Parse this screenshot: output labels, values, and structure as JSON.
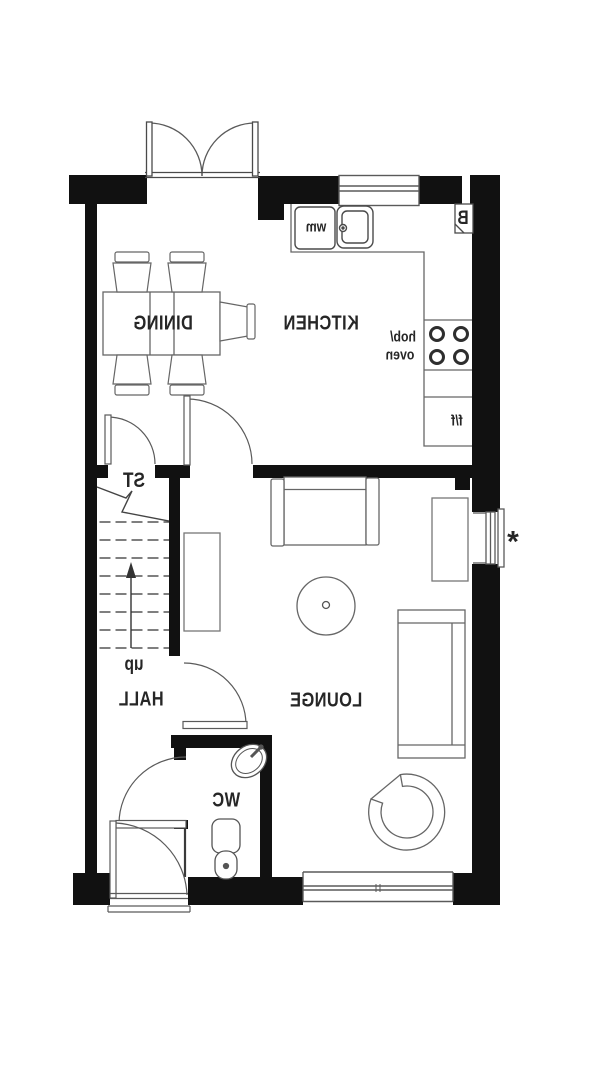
{
  "rooms": {
    "kitchen": "KITCHEN",
    "dining": "DINING",
    "lounge": "LOUNGE",
    "hall": "HALL",
    "wc": "WC",
    "store": "ST"
  },
  "annotations": {
    "stairs_direction": "up",
    "washing_machine": "wm",
    "boiler": "B",
    "hob": "hob/",
    "oven": "oven",
    "fridge_freezer": "f/f",
    "window_note": "*"
  },
  "colors": {
    "wall": "#111111",
    "line": "#666666",
    "fixture_line": "#4a4a4a",
    "text": "#262626",
    "background": "#ffffff"
  }
}
